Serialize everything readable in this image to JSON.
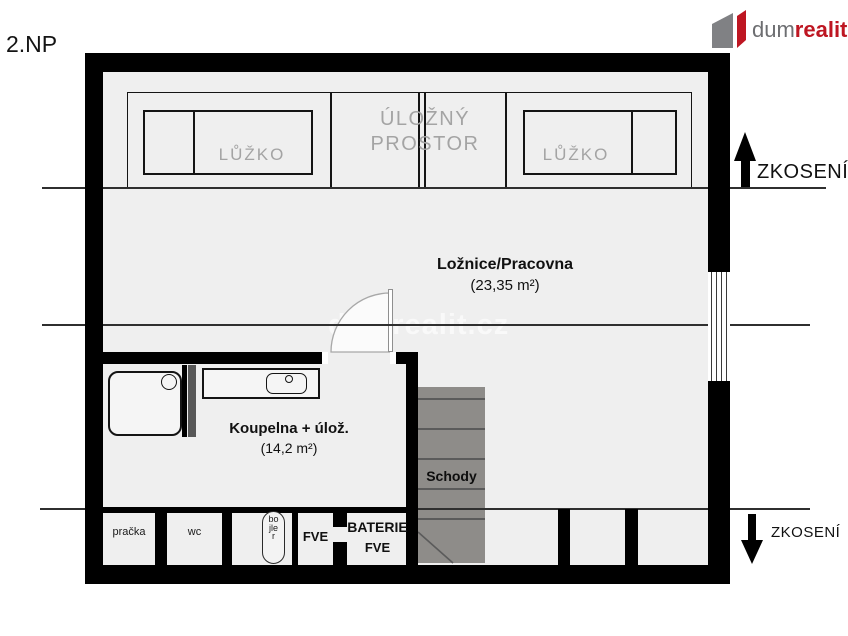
{
  "page": {
    "floor_label": "2.NP"
  },
  "logo": {
    "text_gray": "dum",
    "text_red": "realit.cz",
    "color_gray": "#6d6e71",
    "color_red": "#be1622",
    "icon": "logo-house-icon"
  },
  "watermark": "dumrealit.cz",
  "rooms": {
    "bedroom": {
      "name": "Ložnice/Pracovna",
      "area": "(23,35 m²)"
    },
    "bathroom": {
      "name": "Koupelna + úlož.",
      "area": "(14,2 m²)"
    },
    "stairs": {
      "name": "Schody"
    }
  },
  "furniture": {
    "bed_left": {
      "label": "LŮŽKO"
    },
    "bed_right": {
      "label": "LŮŽKO"
    },
    "storage": {
      "line1": "ÚLOŽNÝ",
      "line2": "PROSTOR"
    }
  },
  "fixtures": {
    "washer": "pračka",
    "wc": "wc",
    "boiler": "bojler",
    "fve": "FVE",
    "battery_line1": "BATERIE",
    "battery_line2": "FVE"
  },
  "annotations": {
    "slope_top": "ZKOSENÍ",
    "slope_bottom": "ZKOSENÍ"
  },
  "colors": {
    "wall": "#000000",
    "floor": "#efefef",
    "stairs": "#8e8c89",
    "brand_red": "#be1622",
    "label_gray": "#a4a4a4"
  }
}
